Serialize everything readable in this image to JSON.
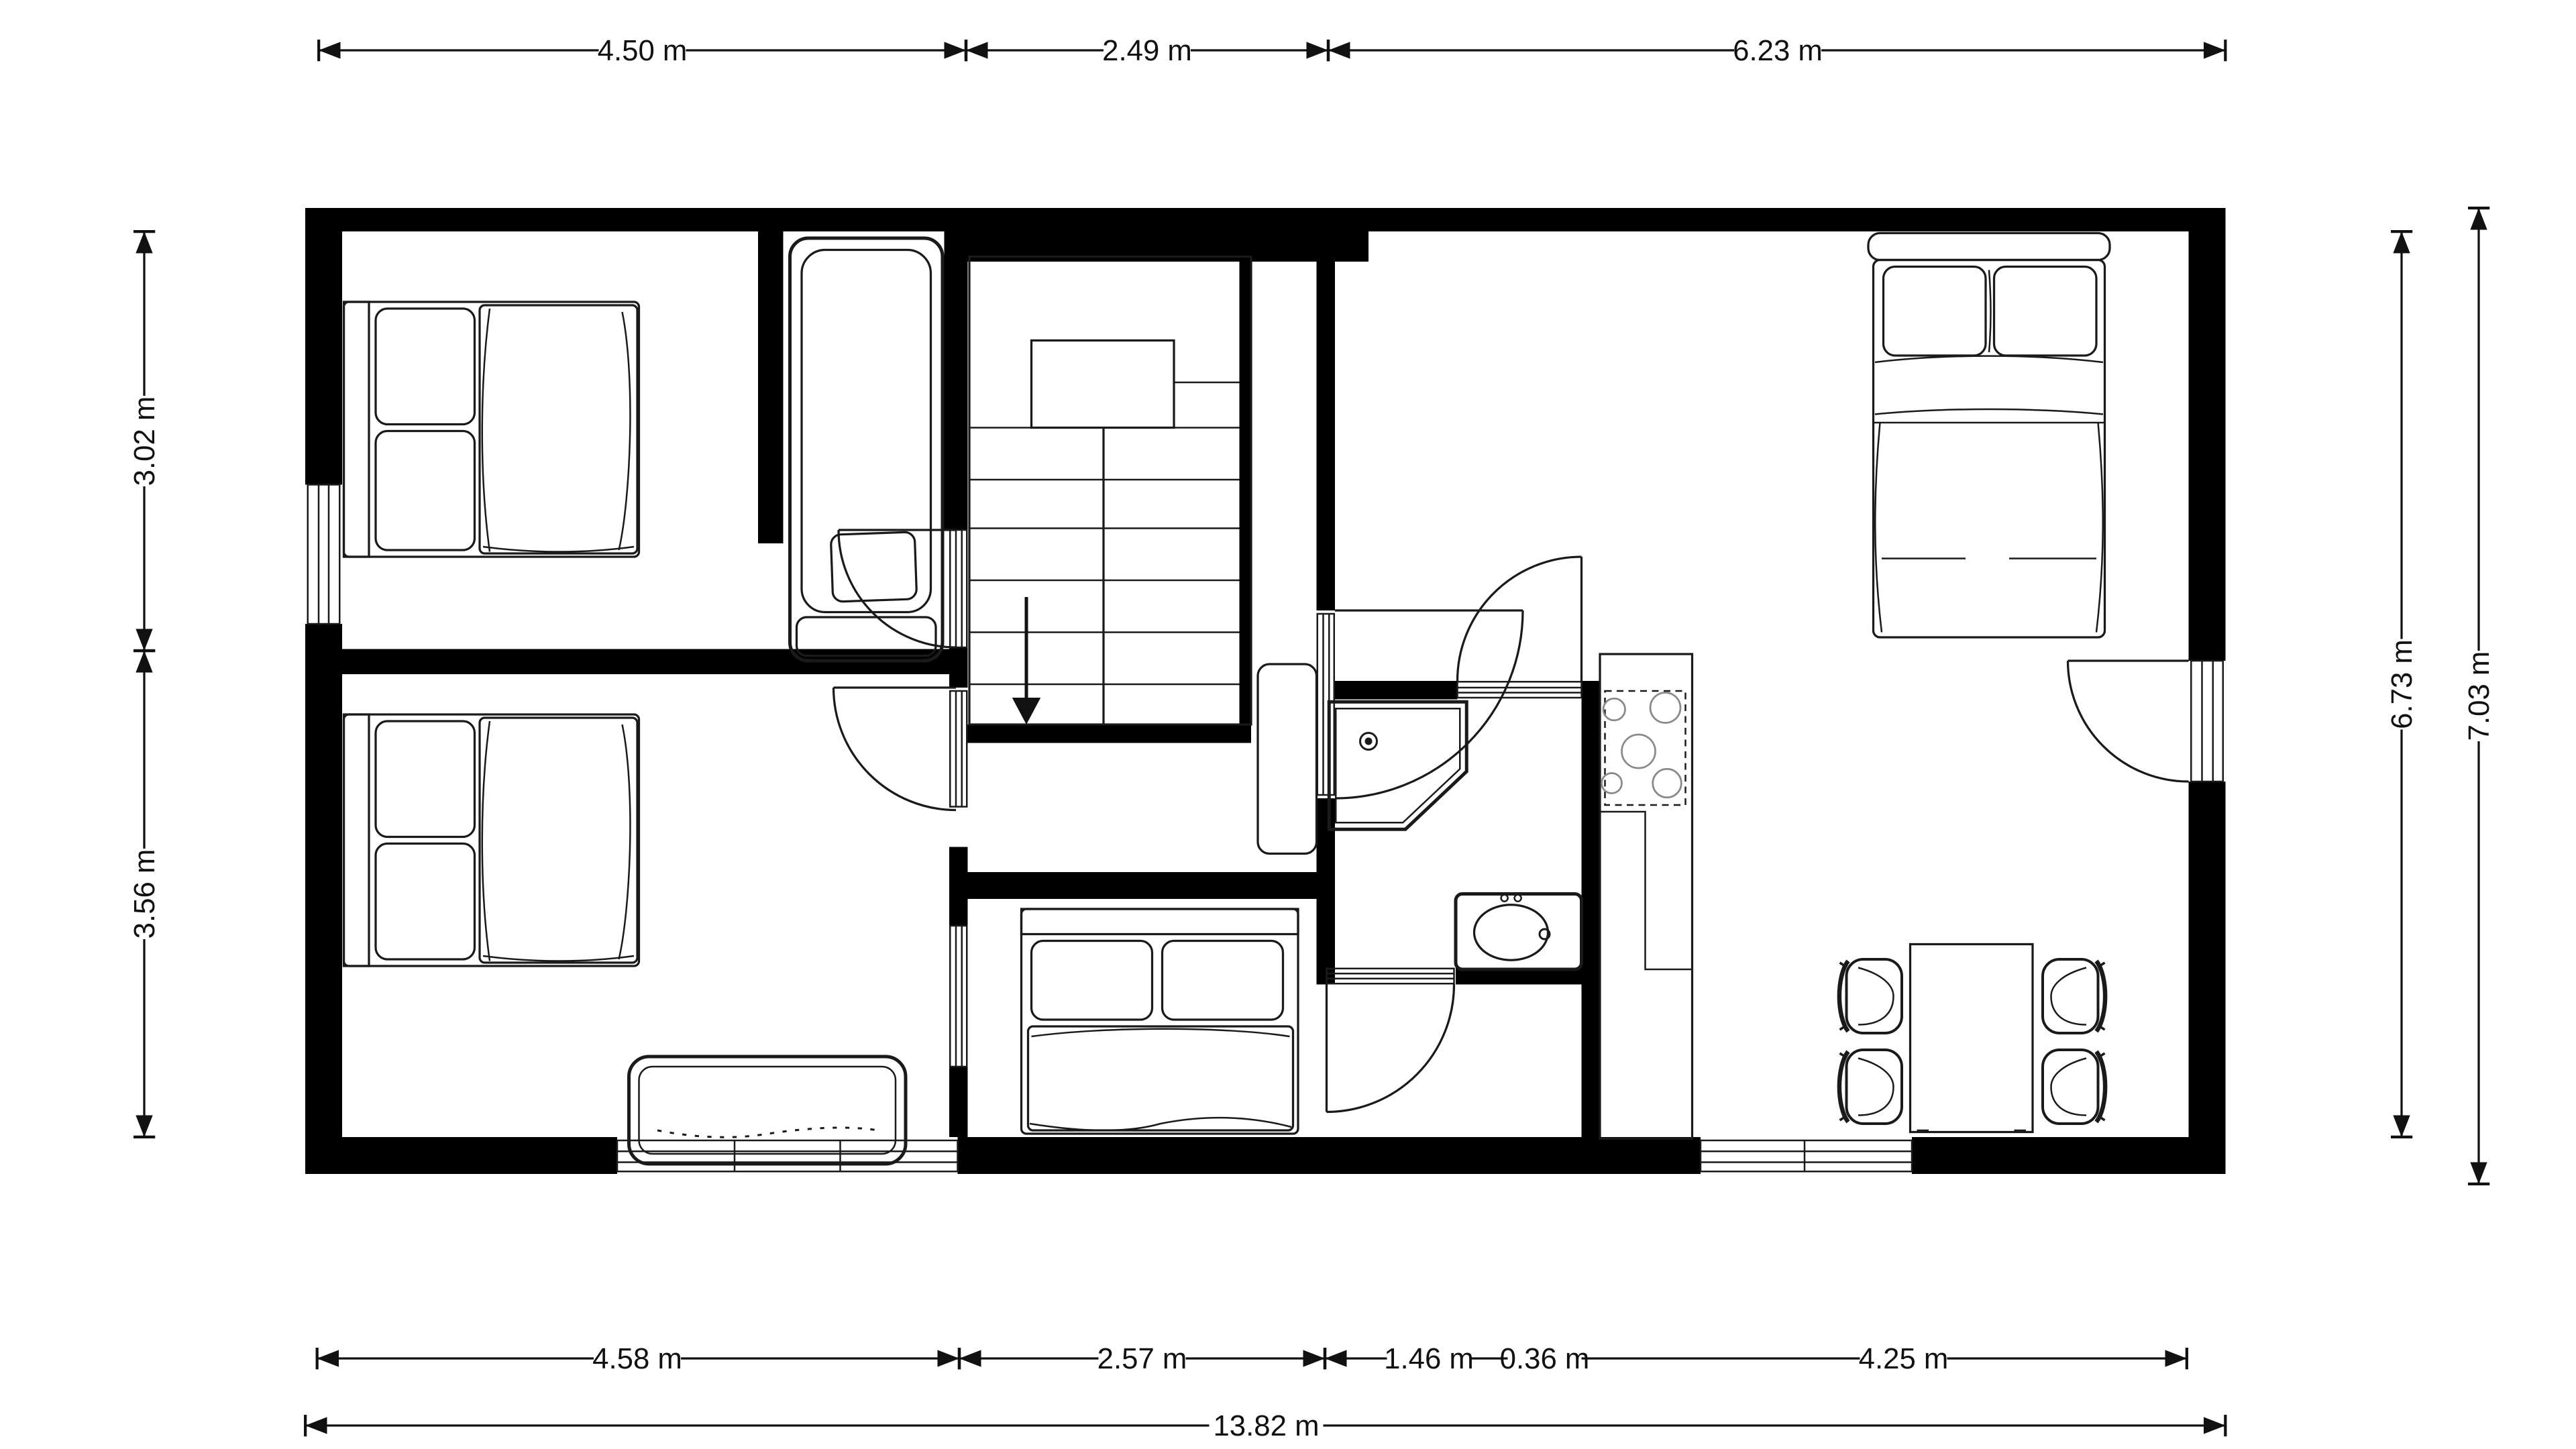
{
  "document": {
    "type": "architectural floor plan",
    "background": "#ffffff"
  },
  "colors": {
    "wall": "#000000",
    "line": "#1a1a1a",
    "dimension_text": "#111111"
  },
  "dimensions": {
    "top": [
      "4.50 m",
      "2.49 m",
      "6.23 m"
    ],
    "left": [
      "3.02 m",
      "3.56 m"
    ],
    "right": [
      "6.73 m",
      "7.03 m"
    ],
    "bottom": [
      "4.58 m",
      "2.57 m",
      "1.46 m",
      "0.36 m",
      "4.25 m"
    ],
    "overall_width": "13.82 m"
  },
  "fixtures": [
    "single-bed",
    "single-bed",
    "single-bed",
    "double-bed",
    "bathtub",
    "corner-shower",
    "washbasin",
    "cooktop-4-burners",
    "kitchen-counter",
    "wardrobe",
    "sofa-bench",
    "dining-table",
    "four-chairs",
    "staircase-down"
  ]
}
